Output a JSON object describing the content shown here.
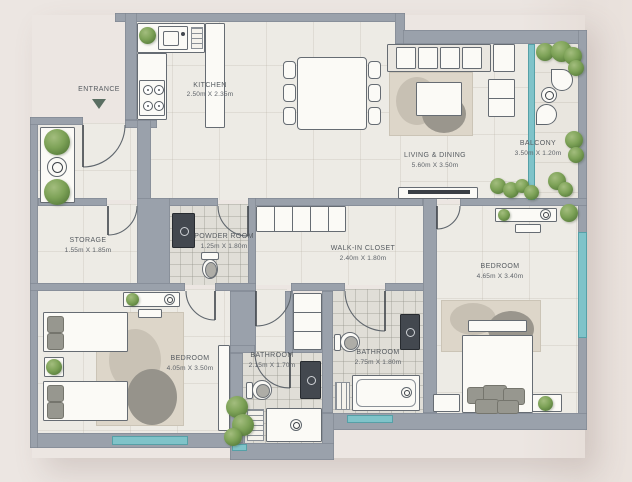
{
  "plan": {
    "entrance_label": "ENTRANCE",
    "rooms": {
      "kitchen": {
        "label": "KITCHEN",
        "dims": "2.50m X 2.35m"
      },
      "living_dining": {
        "label": "LIVING & DINING",
        "dims": "5.60m X 3.50m"
      },
      "balcony": {
        "label": "BALCONY",
        "dims": "3.50m X 1.20m"
      },
      "storage": {
        "label": "STORAGE",
        "dims": "1.55m X 1.85m"
      },
      "powder_room": {
        "label": "POWDER ROOM",
        "dims": "1.25m X 1.80m"
      },
      "walk_in_closet": {
        "label": "WALK-IN CLOSET",
        "dims": "2.40m X 1.80m"
      },
      "bedroom_right": {
        "label": "BEDROOM",
        "dims": "4.65m X 3.40m"
      },
      "bedroom_left": {
        "label": "BEDROOM",
        "dims": "4.05m X 3.50m"
      },
      "bathroom_left": {
        "label": "BATHROOM",
        "dims": "2.15m X 1.70m"
      },
      "bathroom_right": {
        "label": "BATHROOM",
        "dims": "2.75m X 1.80m"
      }
    },
    "colors": {
      "wall": "#9aa1ab",
      "floor": "#edebe5",
      "floor_wet": "#e0ded7",
      "glass": "#7fc3c9",
      "plant": "#7da257",
      "background": "#ece6e2",
      "text": "#565b60"
    }
  }
}
